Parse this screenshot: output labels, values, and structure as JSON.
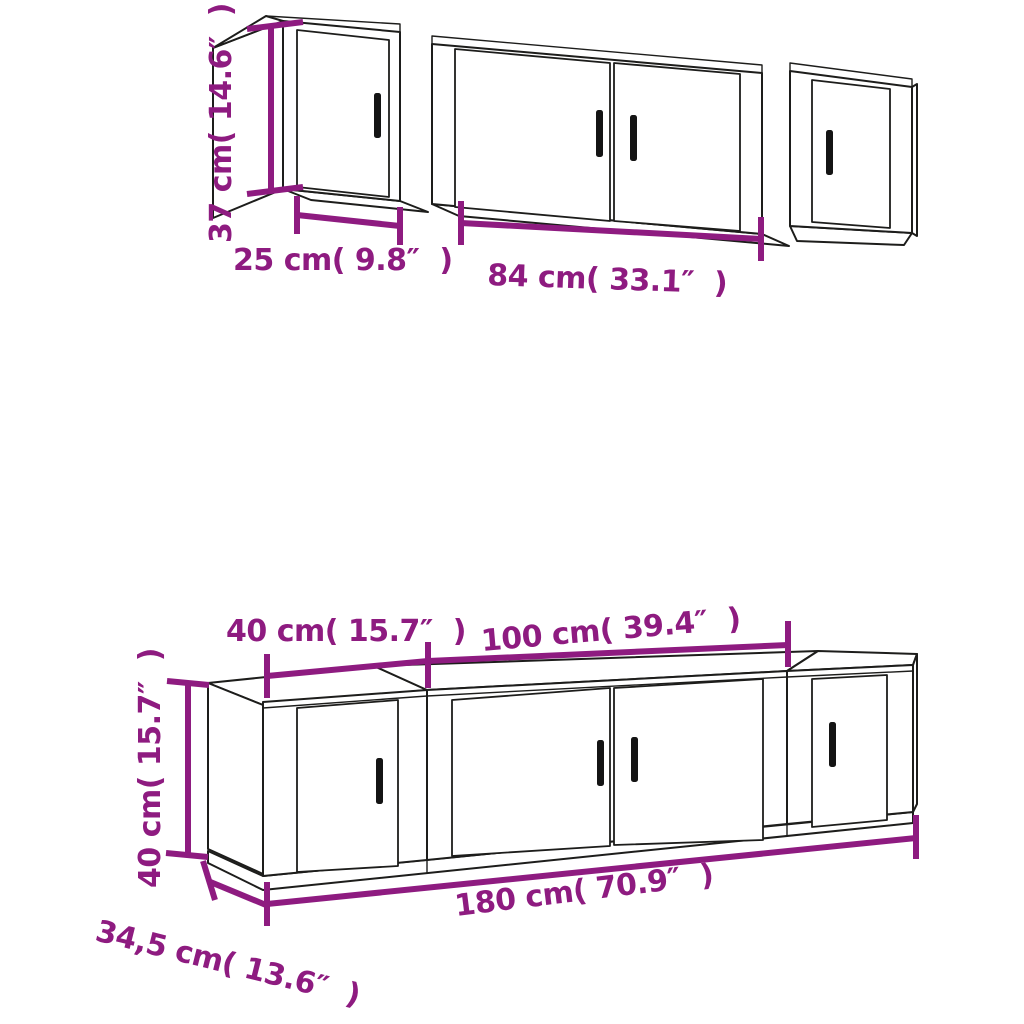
{
  "diagram": {
    "background_color": "#ffffff",
    "line_color": "#1d1d1b",
    "accent_color": "#8e1b80",
    "wall_set": {
      "height_label": "37 cm( 14.6″  )",
      "small_cabinet_width_label": "25 cm( 9.8″  )",
      "large_cabinet_width_label": "84 cm( 33.1″  )"
    },
    "floor_set": {
      "small_cabinet_width_label": "40 cm( 15.7″  )",
      "large_cabinet_width_label": "100 cm( 39.4″  )",
      "height_label": "40 cm( 15.7″  )",
      "total_width_label": "180 cm( 70.9″  )",
      "depth_label": "34,5 cm( 13.6″  )"
    }
  }
}
